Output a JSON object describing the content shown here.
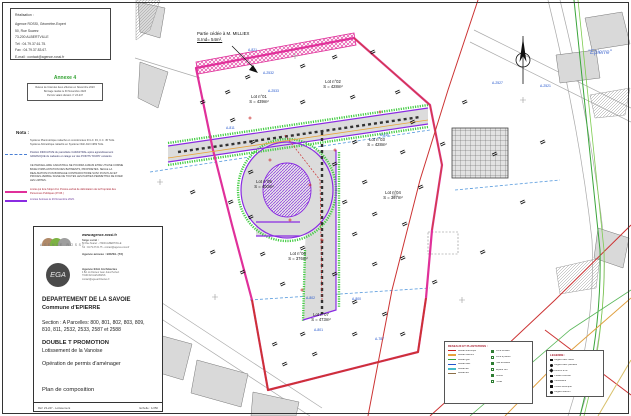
{
  "panel": {
    "realisation": {
      "title": "Réalisation :",
      "lines": [
        "Agence ROSSI, Géomètre-Expert",
        "50, Rue Suarez",
        "73-200 ALBERTVILLE",
        "Tél : 04.79.37.61.75.",
        "Fax : 04.79.37.83.67.",
        "E-mail : contact@agence-rossi.fr"
      ]
    },
    "annexe": {
      "title": "Annexe 4",
      "box_lines": [
        "Relevé de l'état des lieux effectué en Novembre 2023",
        "Bornage réalisé le 30 Novembre 2023",
        "Permis valant division n° 23-247"
      ]
    },
    "nota": {
      "title": "Nota :",
      "geo_lines": [
        "Système Planimétrique rattaché en coordonnées R.G.F. 93, C.C. 45 Télis.",
        "Système Altimétrique rattaché en Système NGF-IGN 1969 Télis."
      ],
      "cadastre_note": "Position INDICATIVE du parcellaire CADASTRAL après agrandissement GRAPHIQUE du cadastre et calage sur des POINTS \"DURS\" existants.",
      "warning": "CE PARCELLAIRE CADASTRAL NE POURRA JAMAIS ETRE UTILISE COMME BASE D'IMPLANTATION DES BATIMENTS, PROPRIETES. SEULE LA REALISATION D'UN BORNAGE CONTRADICTOIRE SUIVI D'UN PLAN ET PROCES-VERBAL SIGNE DE TOUTES LES PARTIES PERMETTRA DE FIXER LES LIMITES.",
      "pv_note": "Limite qui fera l'objet d'un Procès-verbal de délimitation de la Propriété des Personnes Publiques (P.V.B.)",
      "bornage_note": "Limites bornées le 29 Novembre 2023."
    },
    "agency": {
      "rossi_name": "AGENCE ROSSI",
      "website": "www.agence-rossi.fr",
      "siege_label": "Siège social :",
      "siege_lines": [
        "50 Rue Suarez - 73200 ALBERTVILLE",
        "Tél : 04.79.37.61.75 - contact@agence-rossi.fr"
      ],
      "annexe_line": "Agence annexe : BOZEL (73)",
      "ega_name": "EGA",
      "ega_title": "Agence EGA Architectes",
      "ega_lines": [
        "4 Bd. du Docteur Jean Jules Herbert",
        "73100 AIX-LES-BAINS",
        "contact@ega-architectes.fr"
      ]
    },
    "title_block": {
      "departement": "DEPARTEMENT DE LA SAVOIE",
      "commune": "Commune d'EPIERRE",
      "section_line1": "Section : A  Parcelles: 800, 801, 802, 803, 809,",
      "section_line2": "810, 811, 2532, 2533, 2587 et 2588",
      "client": "DOUBLE T PROMOTION",
      "project": "Lotissement de la Vanoise",
      "operation": "Opération de permis d'aménager",
      "doc_title": "Plan de composition",
      "ref": "Réf: 23-247 - Lotissement",
      "scale": "Echelle : 1/250"
    }
  },
  "plan": {
    "cession_line1": "Partie cédée à M. MILLIEX",
    "cession_line2": "S.Ind= 54m².",
    "place_top": "\"Epierre\"",
    "place_bottom": "\"L'Etraz\"",
    "lots": [
      {
        "name": "Lot n°01",
        "area": "S = 439m²"
      },
      {
        "name": "Lot n°02",
        "area": "S = 428m²"
      },
      {
        "name": "Lot n°03",
        "area": "S = 428m²"
      },
      {
        "name": "Lot n°04",
        "area": "S = 367m²"
      },
      {
        "name": "Lot n°05",
        "area": "S = 400m²"
      },
      {
        "name": "Lot n°06",
        "area": "S = 376m²"
      },
      {
        "name": "Lot n°07",
        "area": "S = 473m²"
      }
    ],
    "parcels": [
      "A-821",
      "A-2532",
      "A-2533",
      "A-811",
      "A-810",
      "A-2527",
      "A-2521",
      "A-802",
      "A-800",
      "A-801",
      "A-787"
    ],
    "legend_trees": {
      "title": "RESEAUX ET PLANTATIONS :",
      "left": [
        {
          "label": "Réseau électrique",
          "color": "#cc2222"
        },
        {
          "label": "Réseau télécom",
          "color": "#e8a33d"
        },
        {
          "label": "Réseau gaz",
          "color": "#3aa53a"
        },
        {
          "label": "Réseau AEP",
          "color": "#2255cc"
        },
        {
          "label": "Réseau EP",
          "color": "#44bbcc"
        },
        {
          "label": "Réseau EU",
          "color": "#8b6f47"
        }
      ],
      "right": [
        {
          "label": "Arbre existant"
        },
        {
          "label": "Arbre à planter"
        },
        {
          "label": "Haie existante"
        },
        {
          "label": "Espace vert"
        },
        {
          "label": "Clôture"
        },
        {
          "label": "Portail"
        }
      ]
    },
    "legend_sym": {
      "title": "LEGENDE :",
      "items": [
        "Regard eaux usées",
        "Regard eaux pluviales",
        "Bouche à clé",
        "Poteau incendie",
        "Candélabre",
        "Coffret électrique",
        "Regard télécom"
      ]
    }
  },
  "colors": {
    "boundary_pink": "#e0309a",
    "road_edge_purple": "#8a2be2",
    "verge_green": "#44cc44",
    "network_red": "#cc3333",
    "parcel_label_blue": "#2255cc",
    "annexe_green": "#33a333"
  }
}
